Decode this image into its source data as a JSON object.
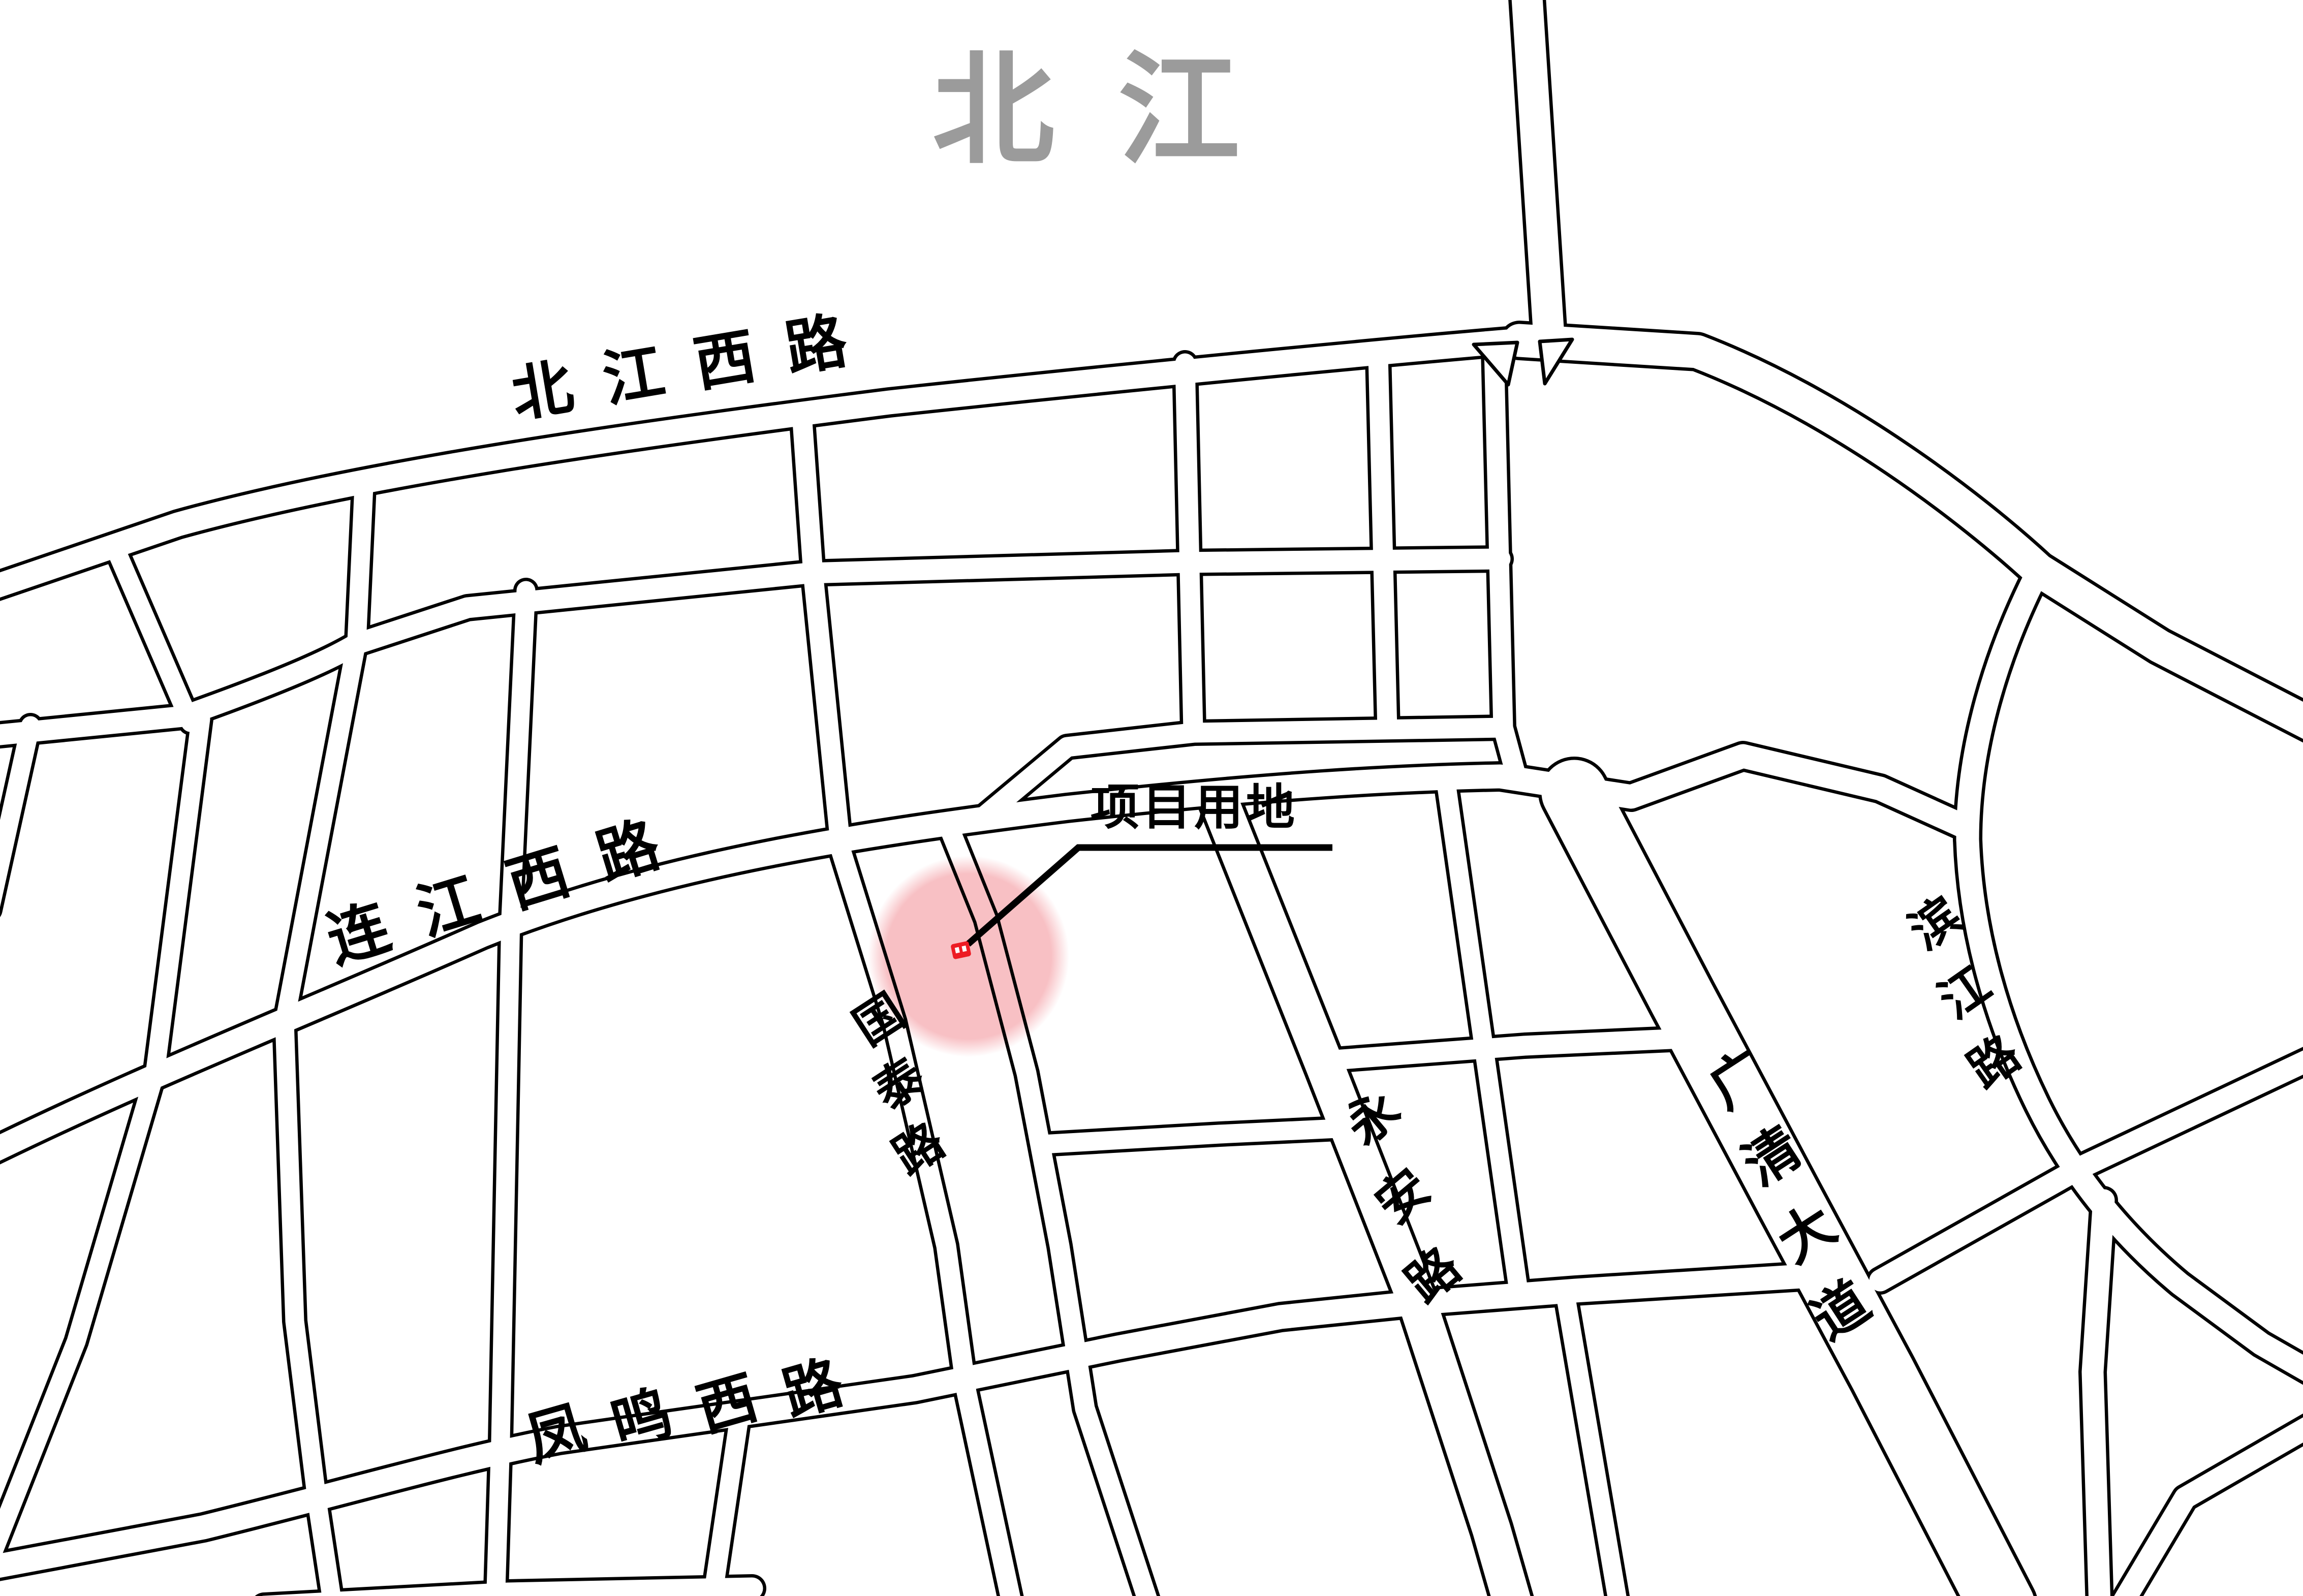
{
  "map_title": {
    "text": "北江",
    "color": "#9b9b9b"
  },
  "project": {
    "label": "项目用地",
    "marker_color": "#ed1c24",
    "highlight_color": "#f8c0c4"
  },
  "road_labels": {
    "beijiang_west": "北江西路",
    "lianjiang_west": "连江西路",
    "fengming_west": "凤鸣西路",
    "guotai": "国泰路",
    "yongan": "永安路",
    "guangqing": "广清大道",
    "binjiang": "滨江路"
  },
  "colors": {
    "road_casing": "#000000",
    "road_fill": "#ffffff",
    "background": "#ffffff"
  }
}
